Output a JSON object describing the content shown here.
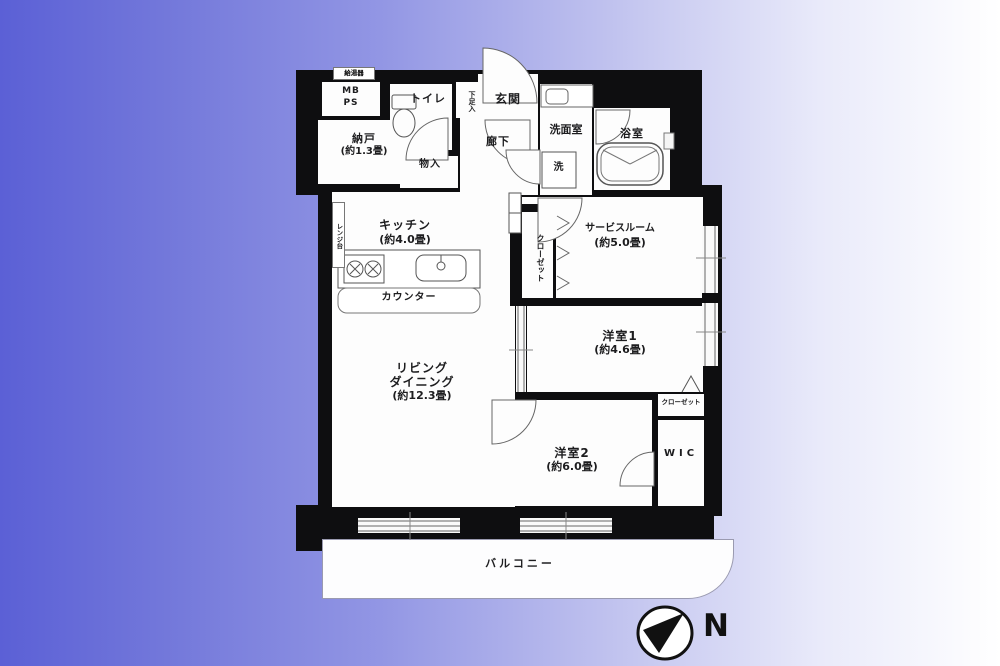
{
  "title": "apartment-floor-plan",
  "colors": {
    "background_left": "#5b60d6",
    "background_right": "#ffffff",
    "wall": "#0e0e10",
    "linework": "#555555"
  },
  "labels": {
    "water_heater": "給湯器",
    "mb": "MB",
    "ps": "PS",
    "nando_name": "納戸",
    "nando_size": "(約1.3畳)",
    "toilet": "トイレ",
    "shoe_box": "下足入",
    "genkan": "玄関",
    "hallway": "廊下",
    "monoire": "物入",
    "washroom": "洗面室",
    "washer": "洗",
    "bathroom": "浴室",
    "kitchen_name": "キッチン",
    "kitchen_size": "(約4.0畳)",
    "range_stand": "レンジ台",
    "counter": "カウンター",
    "closet_service": "クローゼット",
    "service_name": "サービスルーム",
    "service_size": "(約5.0畳)",
    "western1_name": "洋室1",
    "western1_size": "(約4.6畳)",
    "closet_w1": "クローゼット",
    "wic": "WIC",
    "western2_name": "洋室2",
    "western2_size": "(約6.0畳)",
    "living_line1": "リビング",
    "living_line2": "ダイニング",
    "living_size": "(約12.3畳)",
    "balcony": "バルコニー",
    "compass_n": "N"
  }
}
